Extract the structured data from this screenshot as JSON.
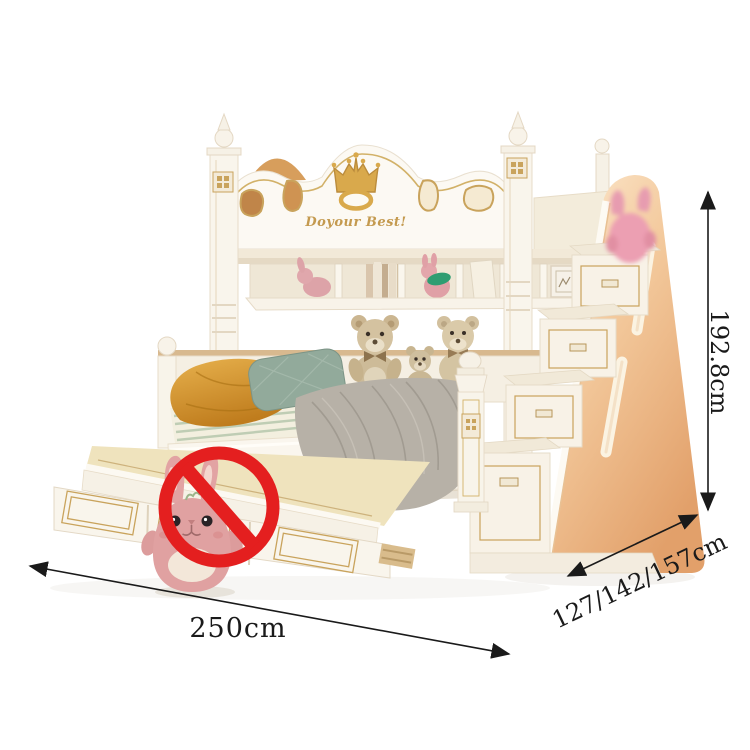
{
  "scene": {
    "headboard": {
      "slogan": "Doyour Best!",
      "emblem": "crown-icon"
    },
    "warning": {
      "icon": "prohibition-icon"
    },
    "toys": [
      "teddy-bear",
      "teddy-bear",
      "teddy-bear",
      "bunny-plush",
      "pink-plush"
    ],
    "furniture": [
      "upper-bunk",
      "storage-shelf",
      "lower-bunk",
      "trundle-drawer",
      "storage-staircase"
    ]
  },
  "dimensions": {
    "width_label": "250cm",
    "height_label": "192.8cm",
    "depth_label": "127/142/157cm"
  },
  "colors": {
    "gold_accent": "#c9a35c",
    "prohibition_red": "#e41f1f",
    "wood_peach": "#edb988",
    "frame_white": "#faf6ee",
    "dimension_line": "#1a1a1a"
  }
}
